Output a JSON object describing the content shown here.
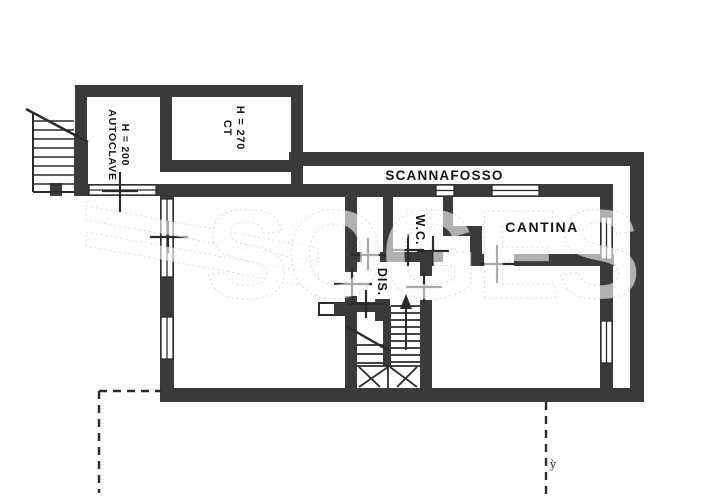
{
  "plan": {
    "labels": {
      "scannafosso": "SCANNAFOSSO",
      "cantina": "CANTINA",
      "wc": "W.C.",
      "dis": "DIS.",
      "autoclave_height": "H = 200",
      "autoclave": "AUTOCLAVE",
      "ct_height": "H = 270",
      "ct": "CT",
      "pen_mark": "ỳ"
    },
    "watermark": "SOGES",
    "colors": {
      "wall": "#3a3a3a",
      "line": "#2b2b2b",
      "background": "#ffffff"
    }
  }
}
